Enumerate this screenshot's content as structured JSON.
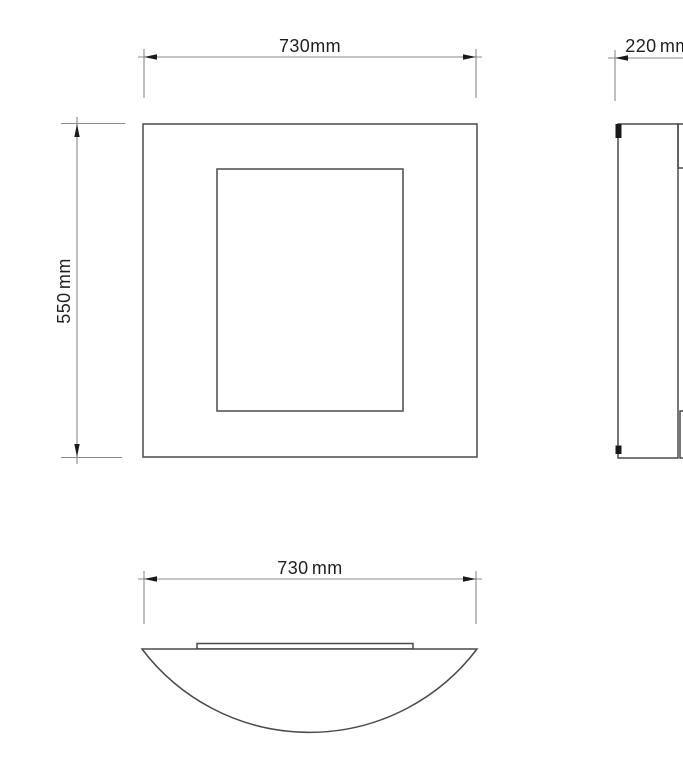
{
  "drawing": {
    "type": "technical-dimension-drawing",
    "background_color": "#ffffff",
    "outline_color": "#4a4a4a",
    "dimension_line_color": "#8a8a8a",
    "arrow_color": "#1a1a1a",
    "text_color": "#1f1f1f",
    "views": {
      "front": {
        "name": "front view"
      },
      "side": {
        "name": "side view"
      },
      "bottom": {
        "name": "bottom view"
      }
    },
    "dimensions": {
      "front_width": {
        "label": "730mm",
        "value": 730,
        "unit": "mm"
      },
      "side_depth": {
        "label": "220 mm",
        "value": 220,
        "unit": "mm"
      },
      "front_height": {
        "label": "550 mm",
        "value": 550,
        "unit": "mm"
      },
      "bottom_width": {
        "label": "730 mm",
        "value": 730,
        "unit": "mm"
      }
    }
  }
}
